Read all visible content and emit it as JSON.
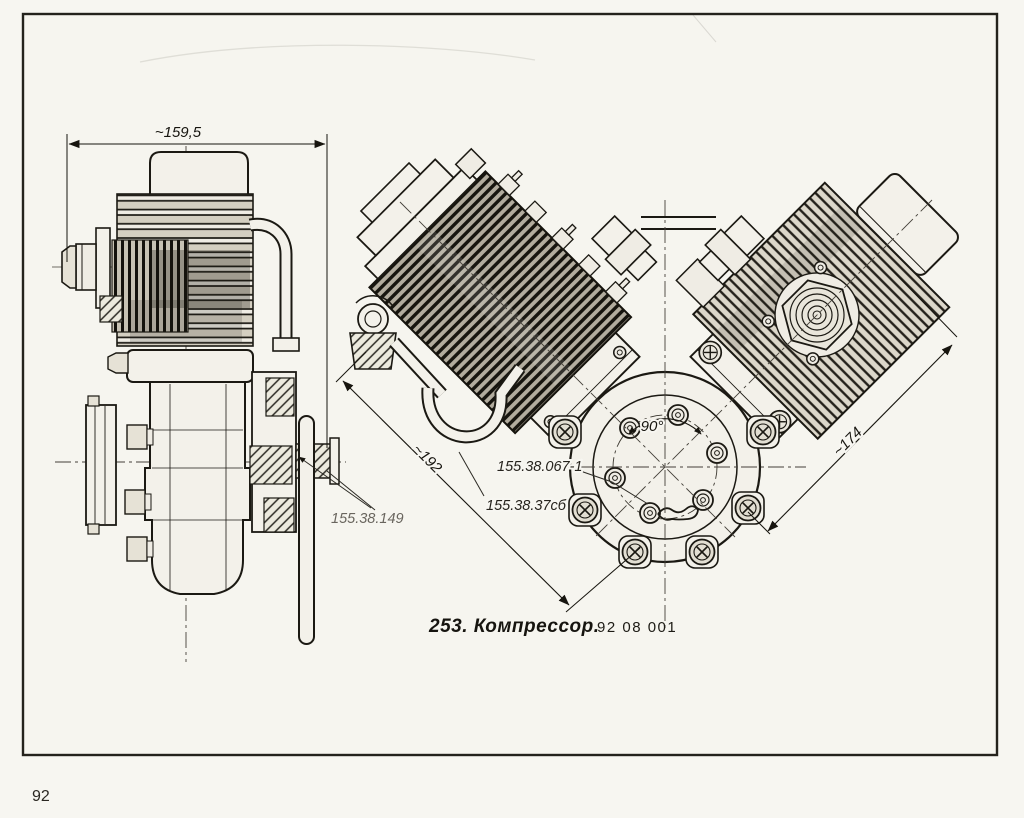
{
  "page": {
    "number": "92"
  },
  "caption": {
    "title": "253. Компрессор.",
    "code": "92 08 001"
  },
  "drawing": {
    "subject": "compressor-two-view-technical-drawing",
    "side_view": {
      "dim_width": "~159,5",
      "label_pulley": "155.38.149"
    },
    "front_view": {
      "dim_left": "~192",
      "dim_right": "~174",
      "angle": "90°",
      "label_cover": "155.38.067-1",
      "label_assembly": "155.38.37сб"
    }
  },
  "colors": {
    "ink": "#1c1a15",
    "paper": "#f7f6f1",
    "fill_light": "#f3f1ea",
    "fin_dark": "#b9b4a7"
  }
}
